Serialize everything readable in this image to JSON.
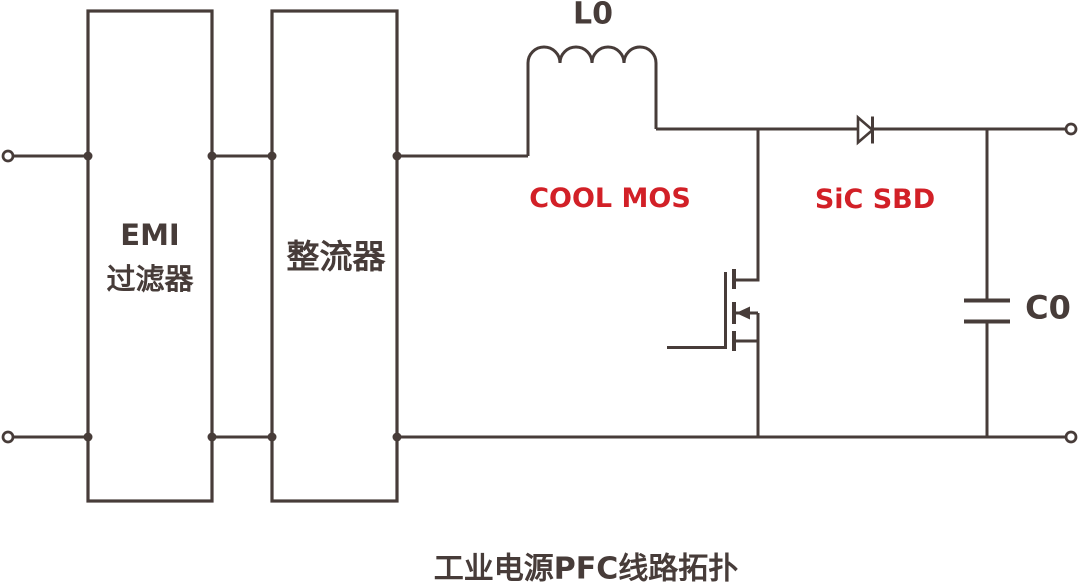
{
  "diagram": {
    "caption": "工业电源PFC线路拓扑",
    "blocks": [
      {
        "lines": [
          "EMI",
          "过滤器"
        ]
      },
      {
        "lines": [
          "整流器"
        ]
      }
    ],
    "components": {
      "inductor_label": "L0",
      "mosfet_label": "COOL MOS",
      "diode_label": "SiC SBD",
      "capacitor_label": "C0"
    }
  },
  "colors": {
    "line": "#473c39",
    "accent_red": "#d22027",
    "background": "#ffffff"
  }
}
